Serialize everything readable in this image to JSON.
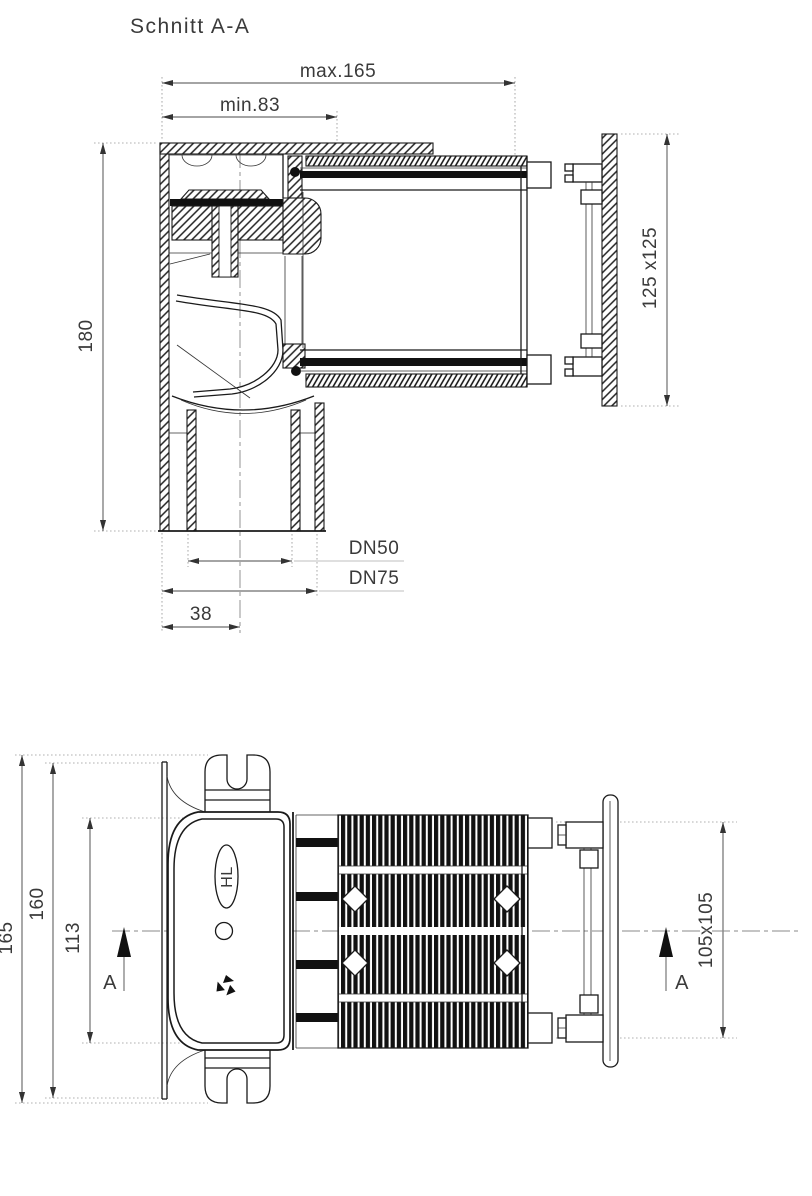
{
  "title": "Schnitt A-A",
  "section_view": {
    "description": "sectional side view of drain body with telescopic square pipe and wall flange",
    "dimensions": {
      "max_width": "max.165",
      "min_width": "min.83",
      "height": "180",
      "flange_size": "125 x125",
      "outlet_dn50": "DN50",
      "outlet_dn75": "DN75",
      "outlet_offset": "38"
    }
  },
  "bottom_view": {
    "description": "bottom view of drain body with mounting plate, corrugated sleeve and wall flange",
    "dimensions": {
      "overall_height": "165",
      "plate_height": "160",
      "body_height": "113",
      "flange_size": "105x105"
    },
    "section_marker": "A",
    "brand": "HL"
  },
  "colors": {
    "line": "#1a1a1a",
    "dim": "#4a4a4a",
    "extension": "#999999",
    "text": "#3a3a3a",
    "dark_fill": "#111111",
    "background": "#ffffff"
  }
}
